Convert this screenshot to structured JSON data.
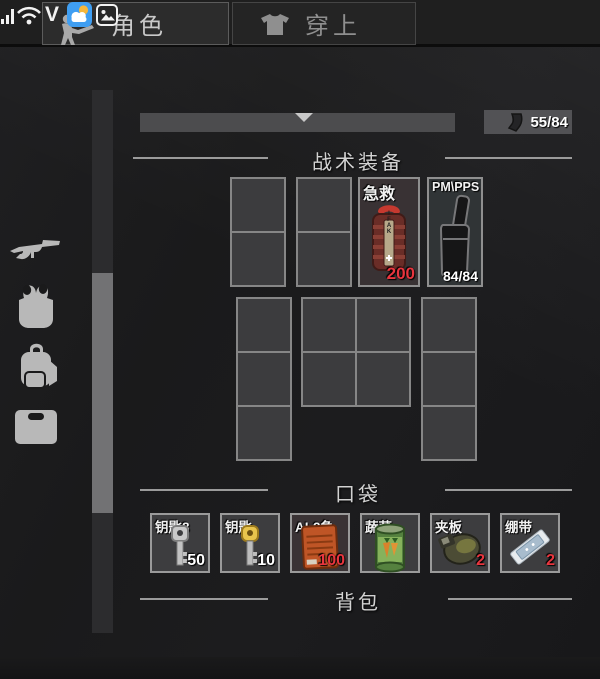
{
  "statusbar": {
    "check_label": "V",
    "icons": [
      "signal-bars",
      "wifi",
      "weather-app",
      "photo-app"
    ]
  },
  "tabs": [
    {
      "label": "角色",
      "active": true,
      "icon": "soldier"
    },
    {
      "label": "穿上",
      "active": false,
      "icon": "tshirt"
    }
  ],
  "equipment_bar": {
    "weapon_mag_count": "55/84"
  },
  "sections": {
    "tactical": "战术装备",
    "pockets": "口袋",
    "backpack": "背包"
  },
  "tactical_items": [
    {
      "label": "急救",
      "icon": "ifak-pouch",
      "icon_text": "IFAK",
      "count": "200",
      "count_color": "#e8353e"
    },
    {
      "label": "PM\\PPS",
      "icon": "pistol-magazine",
      "count": "84/84",
      "count_color": "#ffffff"
    }
  ],
  "pocket_items": [
    {
      "label": "钥匙8",
      "icon": "silver-key",
      "count": "50",
      "count_color": "#ffffff"
    },
    {
      "label": "钥匙",
      "icon": "gold-key",
      "count": "10",
      "count_color": "#ffffff"
    },
    {
      "label": "AI-2急",
      "icon": "med-box",
      "count": "100",
      "count_color": "#e8353e"
    },
    {
      "label": "蔬菜",
      "icon": "vegetable-can",
      "count": "",
      "count_color": "#ffffff"
    },
    {
      "label": "夹板",
      "icon": "splint",
      "count": "2",
      "count_color": "#e8353e"
    },
    {
      "label": "绷带",
      "icon": "bandage",
      "count": "2",
      "count_color": "#e8353e"
    }
  ],
  "sidebar_icons": [
    "rifle",
    "tactical-rig",
    "backpack",
    "case"
  ],
  "colors": {
    "background": "#1a1a1b",
    "slot_fill": "#3d3d3f",
    "slot_border": "#9a9a9a",
    "accent_red": "#e8353e",
    "count_white": "#ffffff",
    "title_text": "#d2d2d2",
    "bar_gray": "#4c4c4e",
    "weather_blue": "#3f9ef2"
  }
}
